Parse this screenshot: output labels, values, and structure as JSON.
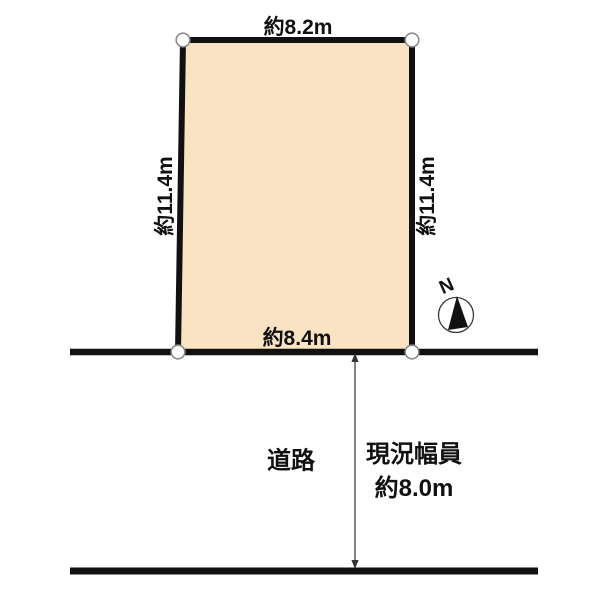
{
  "plot": {
    "fill_color": "#FAE3C2",
    "top_dimension": "約8.2m",
    "bottom_dimension": "約8.4m",
    "left_dimension": "約11.4m",
    "right_dimension": "約11.4m"
  },
  "road": {
    "label": "道路",
    "width_caption_line1": "現況幅員",
    "width_caption_line2": "約8.0m"
  },
  "compass": {
    "north_label": "N"
  },
  "colors": {
    "outline": "#111111",
    "arrow": "#333333",
    "marker_fill": "#ffffff",
    "marker_stroke": "#8c8c8c",
    "background": "#ffffff"
  }
}
